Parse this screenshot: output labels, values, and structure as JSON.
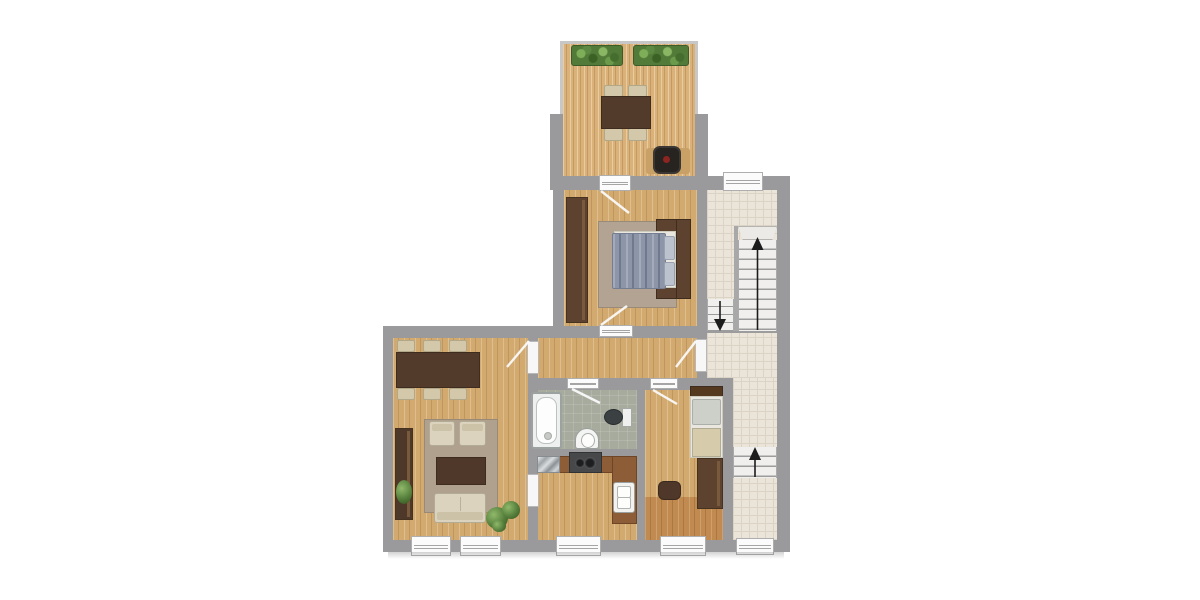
{
  "image": {
    "type": "apartment-floor-plan",
    "background": "#ffffff",
    "orientation": "top-down 2D plan, no text labels rendered"
  },
  "palette": {
    "wall_gray": "#9a999b",
    "wood_floor": "#d2a96e",
    "terrace_deck": "#d9b179",
    "dark_wood_floor": "#c08a50",
    "stairwell_tile": "#eae4d9",
    "bathroom_tile": "#a7ab9d",
    "rug_beige": "#b2a392",
    "upholstery_cream": "#d9d1ba",
    "furniture_dark_brown": "#523b2a",
    "kitchen_counter": "#8d5d38",
    "duvet_blue": "#8d95a8",
    "plant_green": "#567f3c",
    "stair_tread": "#f0efed",
    "window_white": "#fbfbfb",
    "arrow_black": "#1c1c1c",
    "grill_red_dot": "#8c2420"
  },
  "rooms": [
    {
      "id": "terrace",
      "floor": "wood-deck",
      "furniture": [
        "planter-box",
        "planter-box",
        "dining-table-with-4-chairs",
        "bbq-grill-on-mat"
      ]
    },
    {
      "id": "bedroom",
      "floor": "wood",
      "furniture": [
        "wardrobe",
        "double-bed-with-blue-duvet",
        "headboard-frame",
        "rug"
      ]
    },
    {
      "id": "hallway",
      "floor": "wood",
      "furniture": []
    },
    {
      "id": "living-dining-room",
      "floor": "wood",
      "furniture": [
        "dining-table-with-6-chairs",
        "sideboard-with-plant",
        "rug",
        "armchair",
        "armchair",
        "coffee-table",
        "sofa",
        "potted-plant"
      ]
    },
    {
      "id": "bathroom",
      "floor": "tile",
      "furniture": [
        "bathtub",
        "washbasin",
        "toilet"
      ]
    },
    {
      "id": "kitchen",
      "floor": "wood",
      "furniture": [
        "l-shaped-counter",
        "stainless-appliance",
        "stove-two-burners",
        "double-sink"
      ]
    },
    {
      "id": "small-bedroom",
      "floor": "wood",
      "furniture": [
        "single-bed",
        "wardrobe",
        "stool"
      ]
    },
    {
      "id": "stairwell",
      "floor": "tile",
      "furniture": [
        "upper-stair-flight",
        "lower-return-flight",
        "bottom-stair-flight"
      ]
    }
  ],
  "stairs": {
    "arrows": [
      {
        "id": "upper-flight",
        "direction": "up"
      },
      {
        "id": "return-flight",
        "direction": "down"
      },
      {
        "id": "bottom-flight",
        "direction": "up"
      }
    ]
  },
  "openings": {
    "windows": [
      "stairwell-top",
      "living-room-1",
      "living-room-2",
      "kitchen",
      "small-bedroom",
      "stairwell-bottom"
    ],
    "doors": [
      "terrace-door",
      "bedroom-door",
      "apartment-entrance-door",
      "living-room-hall-door",
      "living-room-kitchen-door",
      "bathroom-door",
      "small-bedroom-door"
    ]
  }
}
